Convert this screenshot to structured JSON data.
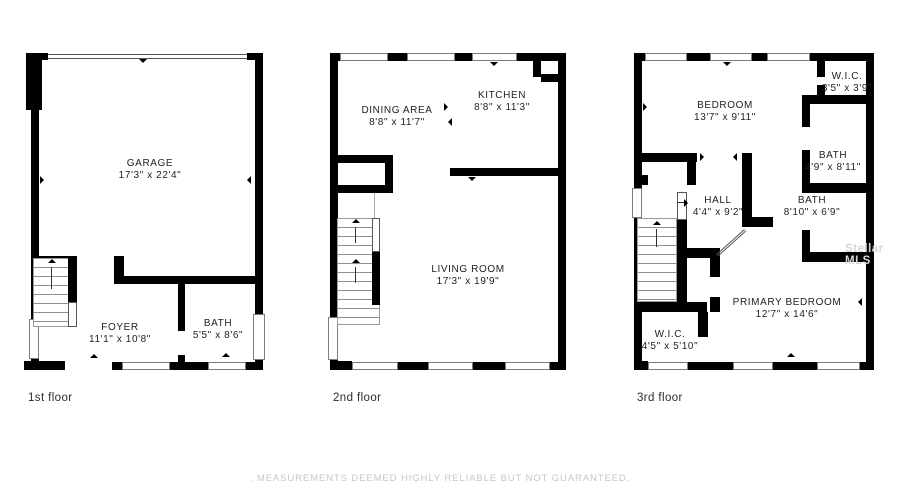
{
  "floors": [
    {
      "caption": "1st floor",
      "rooms": [
        {
          "name": "GARAGE",
          "dims": "17'3\" x 22'4\""
        },
        {
          "name": "FOYER",
          "dims": "11'1\" x 10'8\""
        },
        {
          "name": "BATH",
          "dims": "5'5\" x 8'6\""
        }
      ]
    },
    {
      "caption": "2nd floor",
      "rooms": [
        {
          "name": "DINING AREA",
          "dims": "8'8\" x 11'7\""
        },
        {
          "name": "KITCHEN",
          "dims": "8'8\" x 11'3\""
        },
        {
          "name": "LIVING ROOM",
          "dims": "17'3\" x 19'9\""
        }
      ]
    },
    {
      "caption": "3rd floor",
      "rooms": [
        {
          "name": "BEDROOM",
          "dims": "13'7\" x 9'11\""
        },
        {
          "name": "W.I.C.",
          "dims": "3'5\" x 3'9\""
        },
        {
          "name": "BATH",
          "dims": "4'9\" x 8'11\""
        },
        {
          "name": "HALL",
          "dims": "4'4\" x 9'2\""
        },
        {
          "name": "BATH",
          "dims": "8'10\" x 6'9\""
        },
        {
          "name": "PRIMARY BEDROOM",
          "dims": "12'7\" x 14'6\""
        },
        {
          "name": "W.I.C.",
          "dims": "4'5\" x 5'10\""
        }
      ]
    }
  ],
  "watermark": "Stellar MLS",
  "footer": {
    "disclaimer": ". MEASUREMENTS DEEMED HIGHLY RELIABLE BUT NOT GUARANTEED."
  },
  "colors": {
    "wall": "#000000",
    "background": "#ffffff",
    "label": "#222222",
    "muted": "#c6c6cc"
  }
}
